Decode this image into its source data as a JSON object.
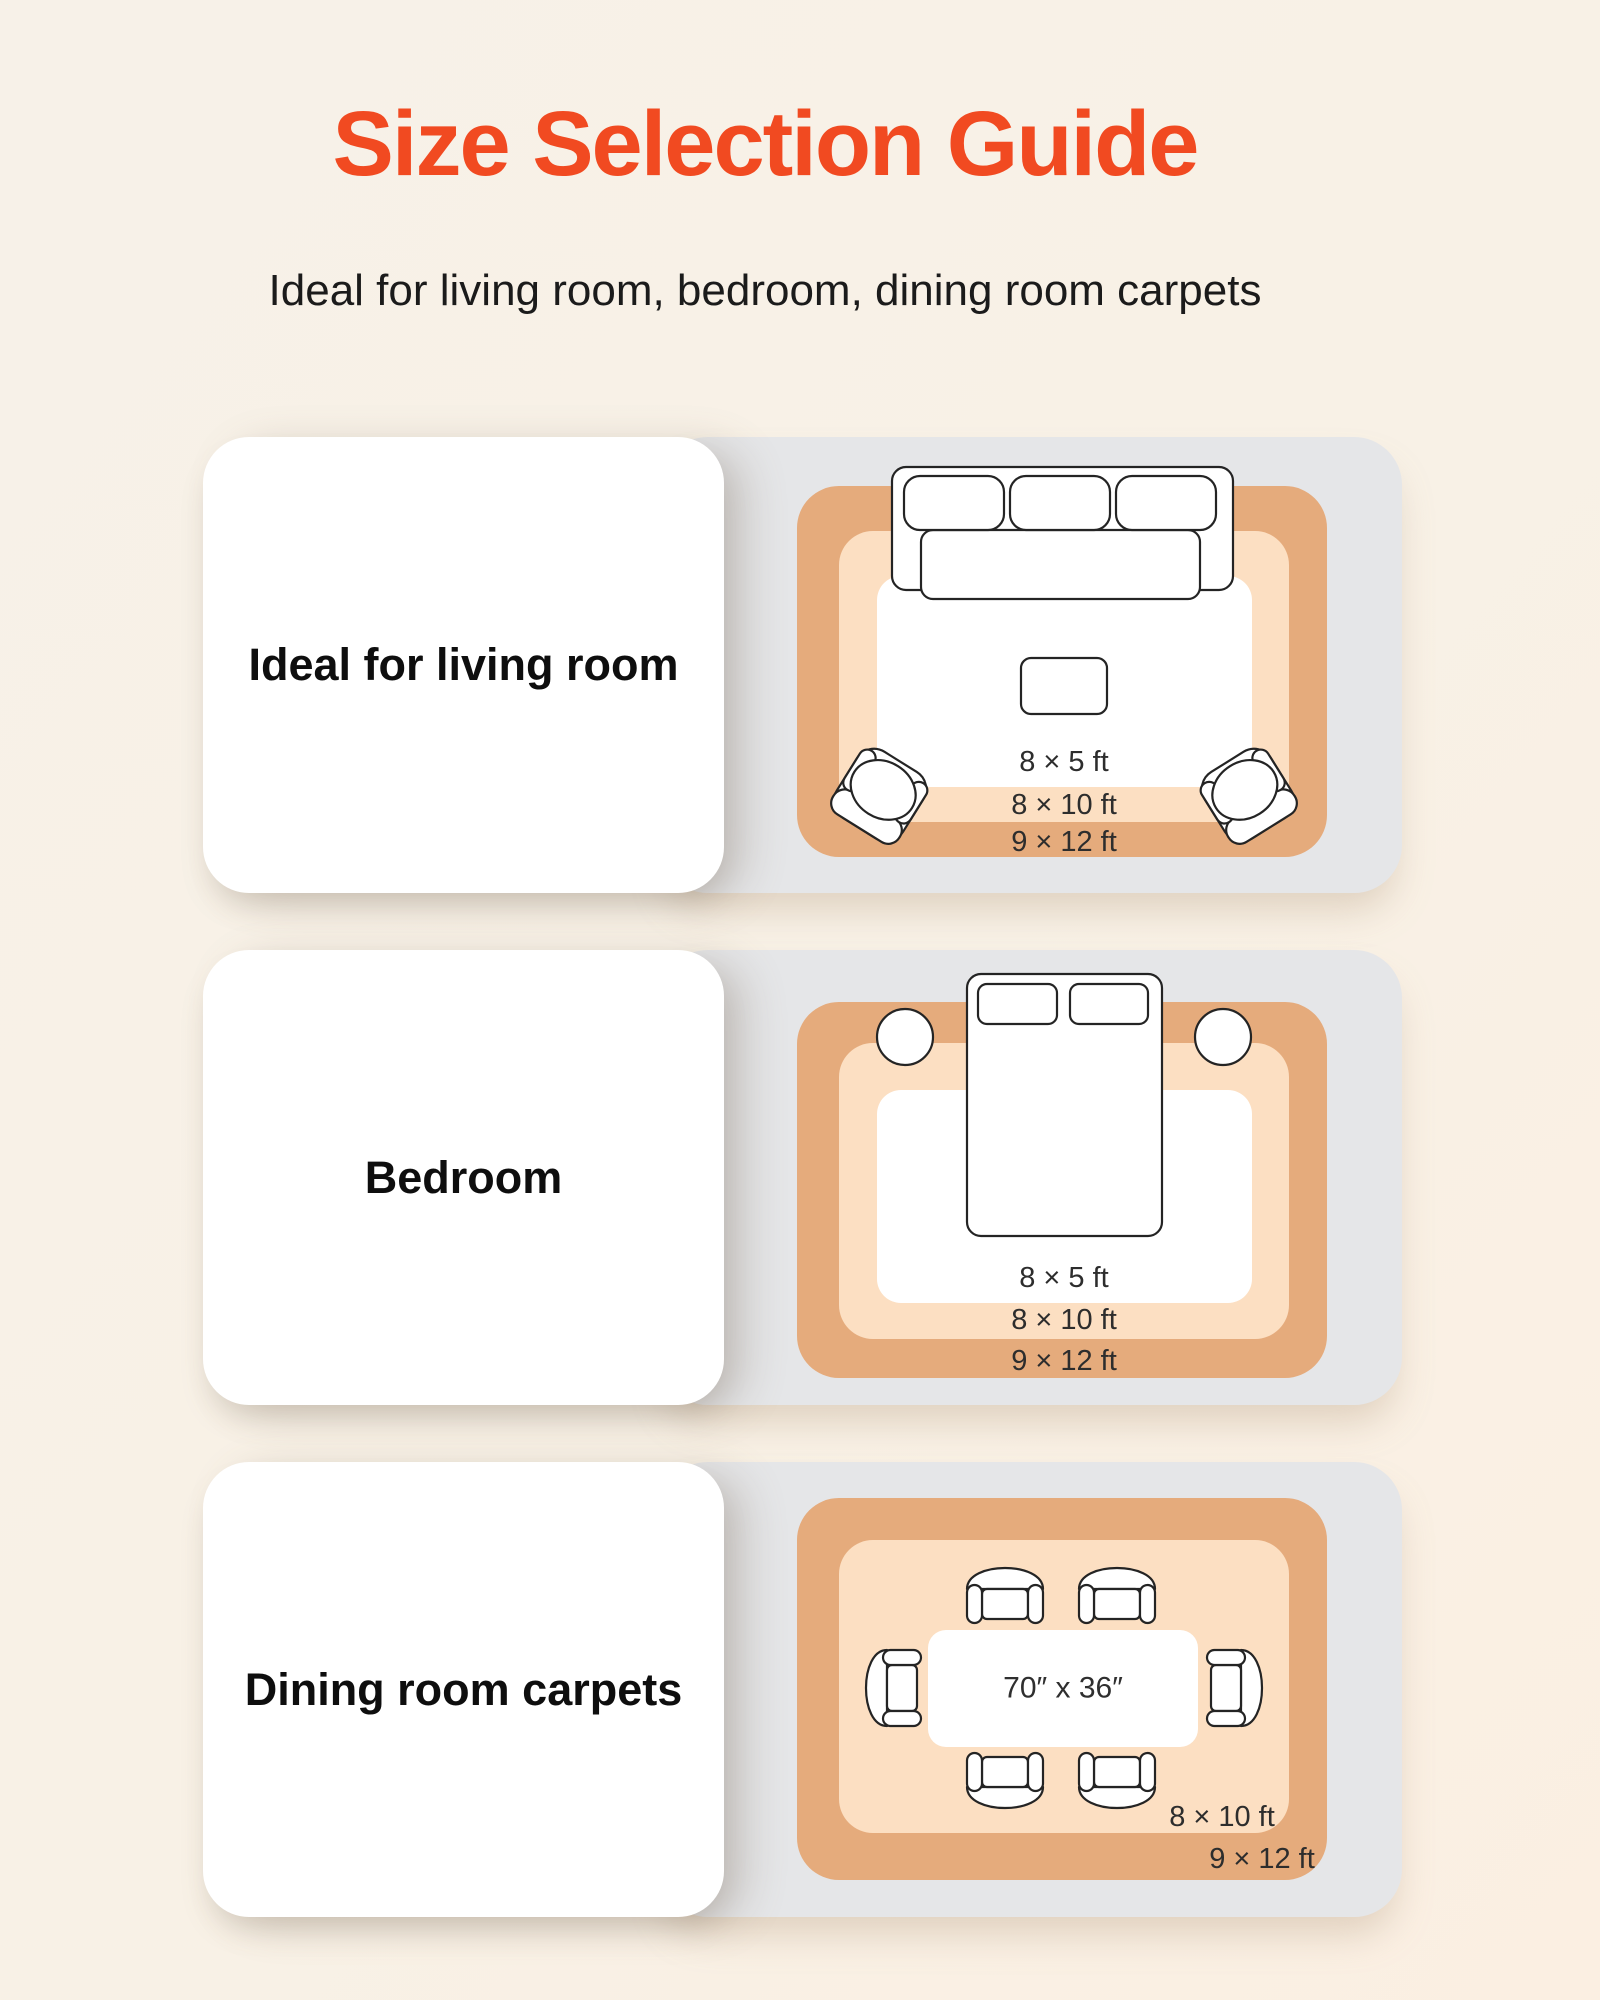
{
  "header": {
    "title": "Size Selection Guide",
    "subtitle": "Ideal for living room, bedroom, dining room carpets"
  },
  "colors": {
    "accent_title": "#f14a21",
    "background_cream": "#f8f1e7",
    "panel_gray": "#e5e6e8",
    "rug_outer_tan": "#e5ab7c",
    "rug_mid_peach": "#fcdfc2",
    "rug_inner_white": "#ffffff",
    "outline_dark": "#242424"
  },
  "rows": [
    {
      "label": "Ideal for living room",
      "scene": "living-room",
      "sizes": [
        "8 × 5 ft",
        "8 × 10 ft",
        "9 × 12 ft"
      ]
    },
    {
      "label": "Bedroom",
      "scene": "bedroom",
      "sizes": [
        "8 × 5 ft",
        "8 × 10 ft",
        "9 × 12 ft"
      ]
    },
    {
      "label": "Dining room carpets",
      "scene": "dining-room",
      "sizes": [
        "8 × 10 ft",
        "9 × 12 ft"
      ],
      "table_size": "70″ x 36″"
    }
  ]
}
